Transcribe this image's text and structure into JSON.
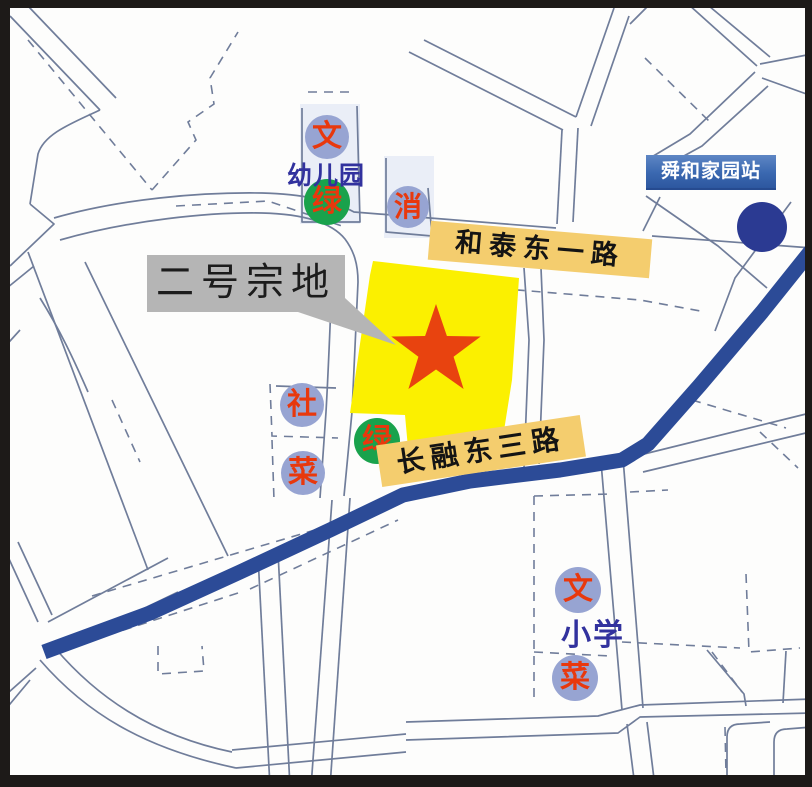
{
  "callout": {
    "text": "二号宗地",
    "bg_color": "#b5b5b5"
  },
  "road_labels": [
    {
      "name": "和泰东一路",
      "bg_color": "#f4cd6e"
    },
    {
      "name": "长融东三路",
      "bg_color": "#f4cd6e"
    }
  ],
  "station": {
    "name": "舜和家园站",
    "box_color": "#3a68b0",
    "dot_color": "#2b3a92"
  },
  "parcel": {
    "fill_color": "#fbf000",
    "star_color": "#e8430f"
  },
  "badges": [
    {
      "char": "文",
      "kind": "culture-facility",
      "bg": "#97a4d2"
    },
    {
      "char": "绿",
      "kind": "green-space",
      "bg": "#19a24c"
    },
    {
      "char": "消",
      "kind": "fire-station",
      "bg": "#97a4d2"
    },
    {
      "char": "社",
      "kind": "community-facility",
      "bg": "#97a4d2"
    },
    {
      "char": "菜",
      "kind": "market",
      "bg": "#97a4d2"
    },
    {
      "char": "绿",
      "kind": "green-space",
      "bg": "#19a24c"
    },
    {
      "char": "文",
      "kind": "culture-facility",
      "bg": "#97a4d2"
    },
    {
      "char": "菜",
      "kind": "market",
      "bg": "#97a4d2"
    }
  ],
  "poi_labels": {
    "kindergarten": "幼儿园",
    "primary_school": "小学",
    "text_color": "#32329e"
  },
  "road_colors": {
    "major": "#2c4b97",
    "minor": "#707d9a"
  }
}
